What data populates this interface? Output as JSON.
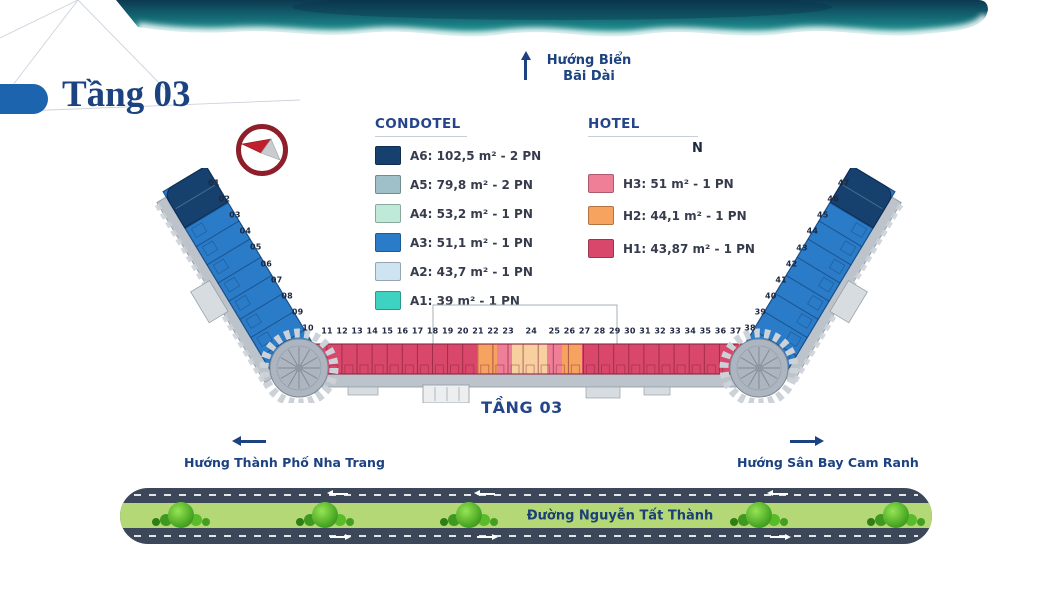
{
  "page": {
    "title": "Tầng 03"
  },
  "header": {
    "sea_direction": {
      "line1": "Hướng Biển",
      "line2": "Bãi Dài"
    }
  },
  "legend": {
    "condotel": {
      "title": "CONDOTEL",
      "items": [
        {
          "code": "A6",
          "label": "A6: 102,5 m² - 2 PN",
          "color": "#16406e"
        },
        {
          "code": "A5",
          "label": "A5: 79,8 m² - 2 PN",
          "color": "#9fc0c8"
        },
        {
          "code": "A4",
          "label": "A4: 53,2 m² - 1 PN",
          "color": "#bfe9d9"
        },
        {
          "code": "A3",
          "label": "A3: 51,1 m² - 1 PN",
          "color": "#2a7cc9"
        },
        {
          "code": "A2",
          "label": "A2: 43,7 m² - 1 PN",
          "color": "#cfe4f2"
        },
        {
          "code": "A1",
          "label": "A1: 39 m² - 1 PN",
          "color": "#3ed2c2"
        }
      ]
    },
    "hotel": {
      "title": "HOTEL",
      "north_label": "N",
      "items": [
        {
          "code": "H3",
          "label": "H3: 51 m² - 1 PN",
          "color": "#ee7f97"
        },
        {
          "code": "H2",
          "label": "H2: 44,1 m² - 1 PN",
          "color": "#f5a35e"
        },
        {
          "code": "H1",
          "label": "H1: 43,87 m² - 1 PN",
          "color": "#d9486b"
        }
      ]
    }
  },
  "plan": {
    "floor_label": "TẦNG 03",
    "left_wing_units": [
      "01",
      "02",
      "03",
      "04",
      "05",
      "06",
      "07",
      "08",
      "09",
      "10"
    ],
    "center_units": [
      "11",
      "12",
      "13",
      "14",
      "15",
      "16",
      "17",
      "18",
      "19",
      "20",
      "21",
      "22",
      "23",
      "24",
      "25",
      "26",
      "27",
      "28",
      "29",
      "30",
      "31",
      "32",
      "33",
      "34",
      "35",
      "36",
      "37"
    ],
    "right_wing_units": [
      "38",
      "39",
      "40",
      "41",
      "42",
      "43",
      "44",
      "45",
      "46",
      "47"
    ]
  },
  "directions": {
    "city": "Hướng Thành Phố Nha Trang",
    "airport": "Hướng Sân Bay Cam Ranh"
  },
  "road": {
    "name": "Đường Nguyễn Tất Thành"
  },
  "colors": {
    "accent_blue": "#1d64ae",
    "navy_text": "#1c4280",
    "compass_red": "#8e1f2a",
    "road_asphalt": "#3c4859",
    "road_green": "#b4d876",
    "wave_teal": "#136672"
  }
}
